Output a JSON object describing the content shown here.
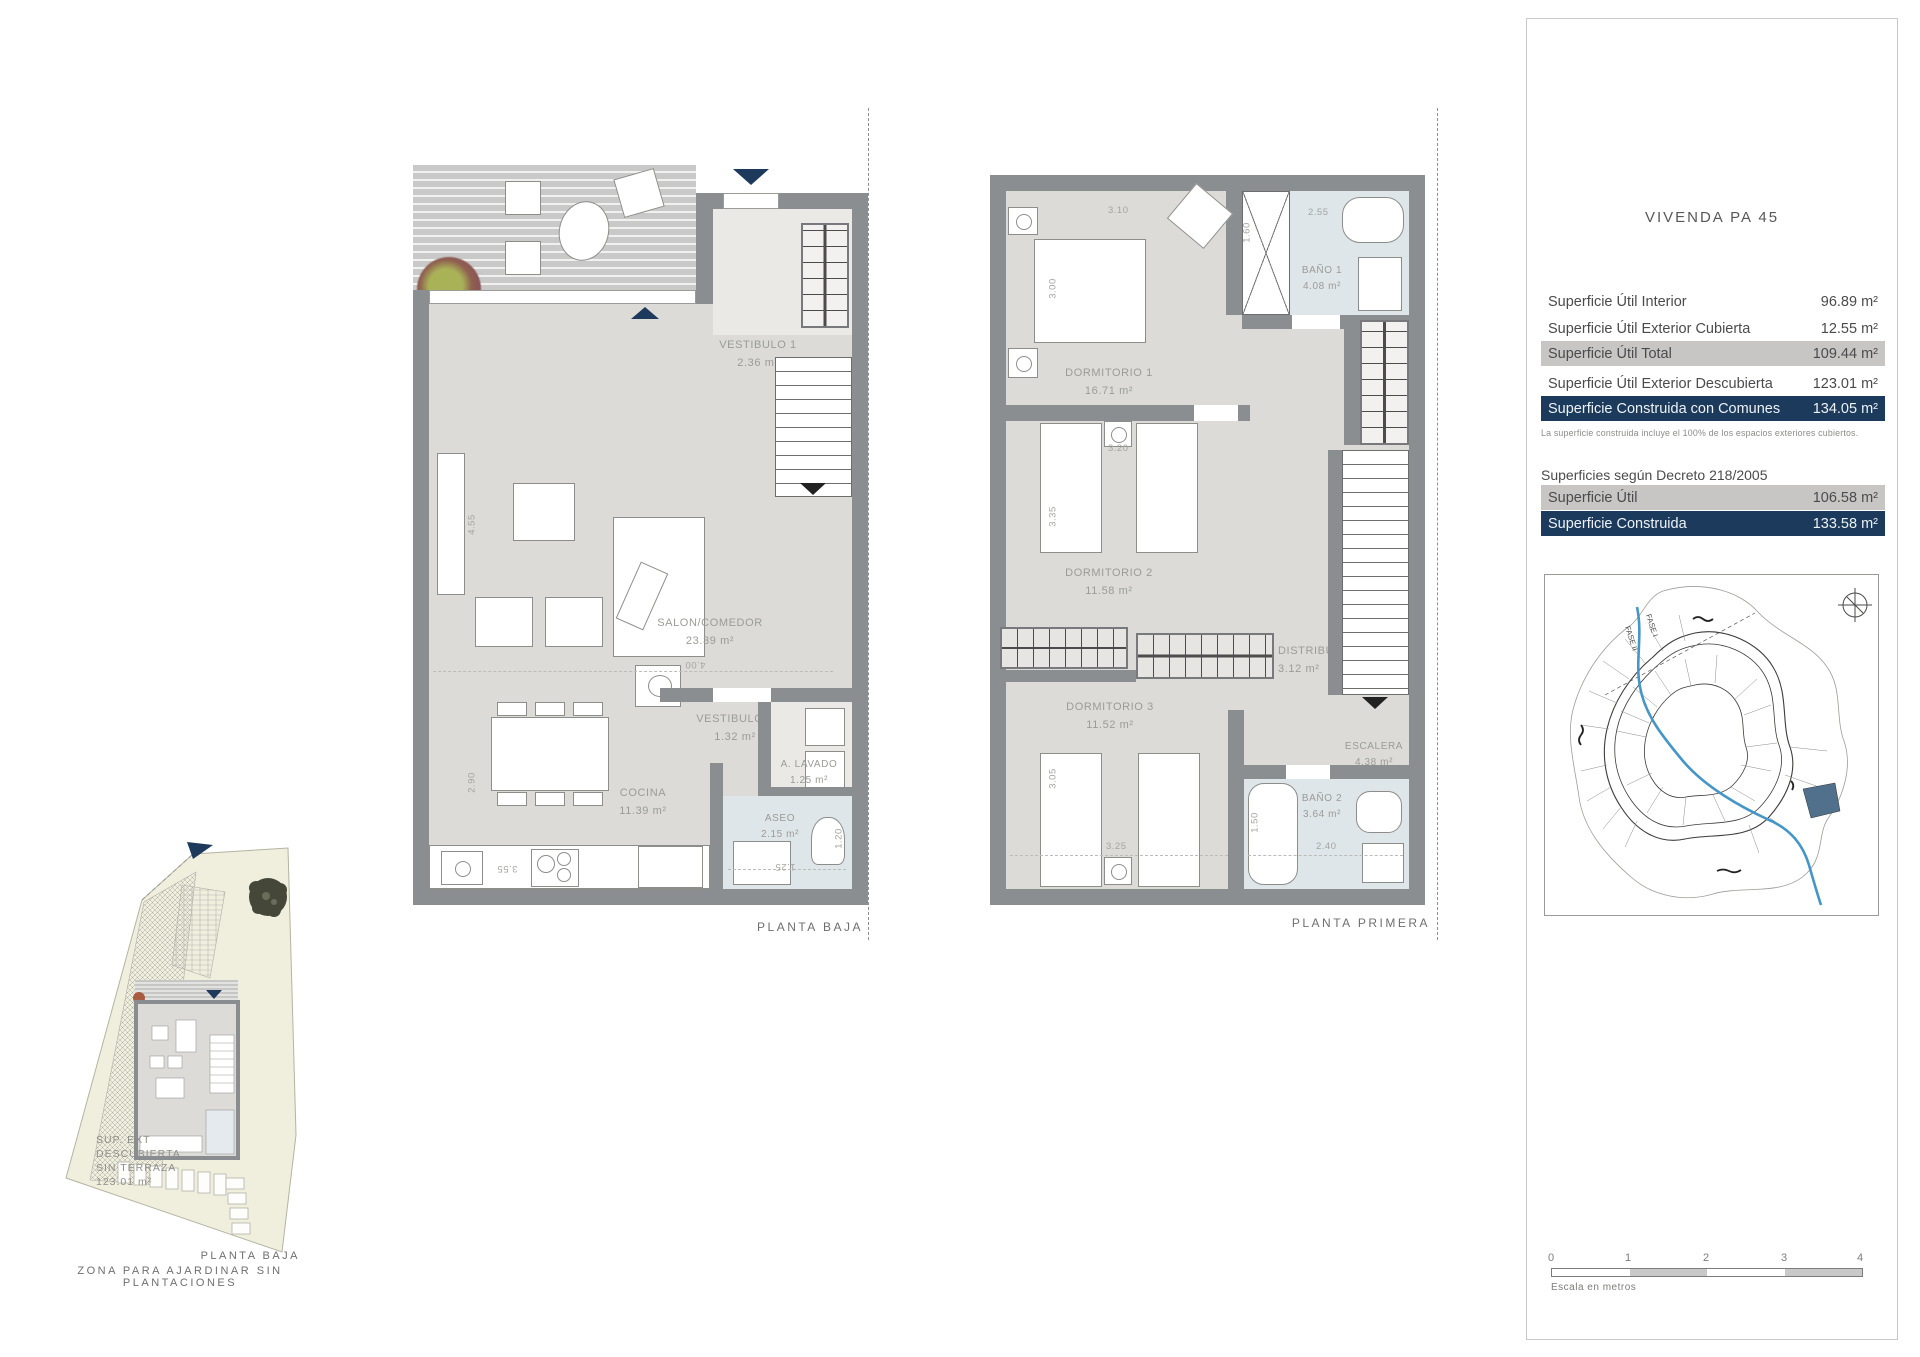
{
  "gf": {
    "caption": "PLANTA BAJA",
    "rooms": {
      "porche": {
        "name": "PORCHE",
        "area": "12.55 m²"
      },
      "vestibulo1": {
        "name": "VESTIBULO 1",
        "area": "2.36 m²"
      },
      "salon": {
        "name": "SALON/COMEDOR",
        "area": "23.39 m²"
      },
      "vestibulo2": {
        "name": "VESTIBULO 2",
        "area": "1.32 m²"
      },
      "lavado": {
        "name": "A. LAVADO",
        "area": "1.25 m²"
      },
      "cocina": {
        "name": "COCINA",
        "area": "11.39 m²"
      },
      "aseo": {
        "name": "ASEO",
        "area": "2.15 m²"
      }
    },
    "dims": {
      "v455": "4.55",
      "v290": "2.90",
      "h400": "4.00",
      "h355": "3.55",
      "v120": "1.20",
      "h125": "1.25"
    }
  },
  "ff": {
    "caption": "PLANTA PRIMERA",
    "rooms": {
      "dormitorio1": {
        "name": "DORMITORIO 1",
        "area": "16.71 m²"
      },
      "bano1": {
        "name": "BAÑO 1",
        "area": "4.08 m²"
      },
      "dormitorio2": {
        "name": "DORMITORIO 2",
        "area": "11.58 m²"
      },
      "distribuidor": {
        "name": "DISTRIBUIDOR",
        "area": "3.12 m²"
      },
      "dormitorio3": {
        "name": "DORMITORIO 3",
        "area": "11.52 m²"
      },
      "escalera": {
        "name": "ESCALERA",
        "area": "4.38 m²"
      },
      "bano2": {
        "name": "BAÑO 2",
        "area": "3.64 m²"
      }
    },
    "dims": {
      "h310": "3.10",
      "v300": "3.00",
      "h255": "2.55",
      "v160": "1.60",
      "h320": "3.20",
      "v335": "3.35",
      "v305": "3.05",
      "h325": "3.25",
      "v150": "1.50",
      "h240": "2.40"
    }
  },
  "site": {
    "sup1": "SUP. EXT",
    "sup2": "DESCUBIERTA",
    "sup3": "SIN TERRAZA",
    "sup4": "123.01 m²",
    "caption1": "PLANTA BAJA",
    "caption2": "ZONA PARA AJARDINAR  SIN PLANTACIONES"
  },
  "panel": {
    "title": "VIVENDA PA 45",
    "rows": [
      {
        "label": "Superficie Útil Interior",
        "value": "96.89 m²"
      },
      {
        "label": "Superficie Útil Exterior Cubierta",
        "value": "12.55 m²"
      },
      {
        "label": "Superficie Útil Total",
        "value": "109.44 m²"
      },
      {
        "label": "Superficie Útil Exterior Descubierta",
        "value": "123.01 m²"
      },
      {
        "label": "Superficie Construida con Comunes",
        "value": "134.05 m²"
      }
    ],
    "note": "La superficie construida incluye el 100% de los espacios exteriores cubiertos.",
    "decree_heading": "Superficies según Decreto 218/2005",
    "decree_rows": [
      {
        "label": "Superficie Útil",
        "value": "106.58 m²"
      },
      {
        "label": "Superficie Construida",
        "value": "133.58 m²"
      }
    ],
    "map": {
      "fase1": "FASE I",
      "fase2": "FASE II"
    },
    "scale": {
      "ticks": [
        "0",
        "1",
        "2",
        "3",
        "4"
      ],
      "label": "Escala en metros"
    }
  },
  "colors": {
    "navy": "#1c3a5c",
    "row_gray": "#c7c6c4",
    "bath_blue": "#dfe6ea",
    "floor": "#dcdbd7",
    "wall": "#8b8e91",
    "stream_blue": "#4596c8",
    "plot_cream": "#f0eedd"
  }
}
